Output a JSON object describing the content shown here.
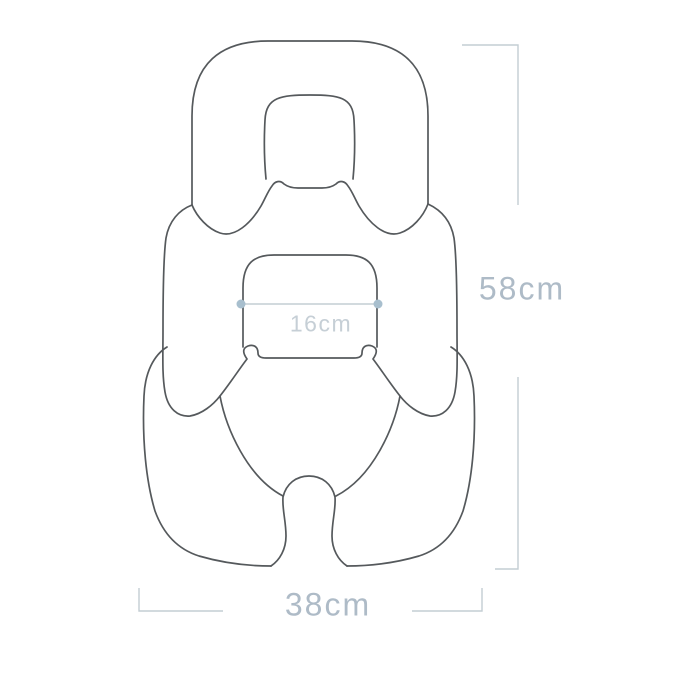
{
  "canvas": {
    "width": 697,
    "height": 677
  },
  "colors": {
    "background": "#ffffff",
    "outline": "#55595c",
    "measure_line": "#c3cdd3",
    "label_large": "#aebbc7",
    "label_small": "#c6cfd6",
    "dot": "#a8bfce"
  },
  "diagram": {
    "name": "baby-seat-pad-dimension-diagram",
    "measurements": {
      "height": {
        "label": "58cm"
      },
      "width": {
        "label": "38cm"
      },
      "inner_width": {
        "label": "16cm"
      }
    }
  }
}
